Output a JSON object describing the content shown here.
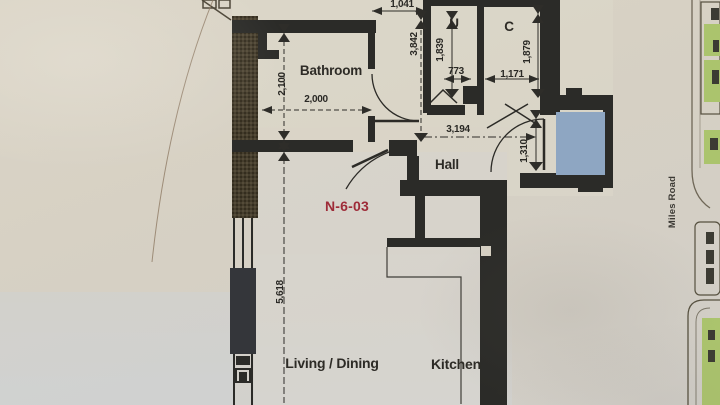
{
  "floorplan": {
    "unit_label": "N-6-03",
    "street_label": "Miles Road",
    "rooms": {
      "bathroom": "Bathroom",
      "utility_closet": "U",
      "coat_closet": "C",
      "hall": "Hall",
      "living_dining": "Living / Dining",
      "kitchen": "Kitchen"
    },
    "dimensions": {
      "balcony_opening_width": "1,041",
      "upper_zone_height": "3,842",
      "utility_depth": "1,839",
      "utility_width": "773",
      "closet_width": "1,171",
      "closet_depth": "1,879",
      "bathroom_depth": "2,100",
      "bathroom_width": "2,000",
      "hall_width": "3,194",
      "entry_recess": "1,310",
      "living_length": "5,618"
    },
    "colors": {
      "wall_ink": "#2c2b27",
      "paper": "#d6d0c3",
      "shaft_blue": "#8ea6c2",
      "unit_label_red": "#9e2b38",
      "site_green": "#abc46d"
    }
  }
}
